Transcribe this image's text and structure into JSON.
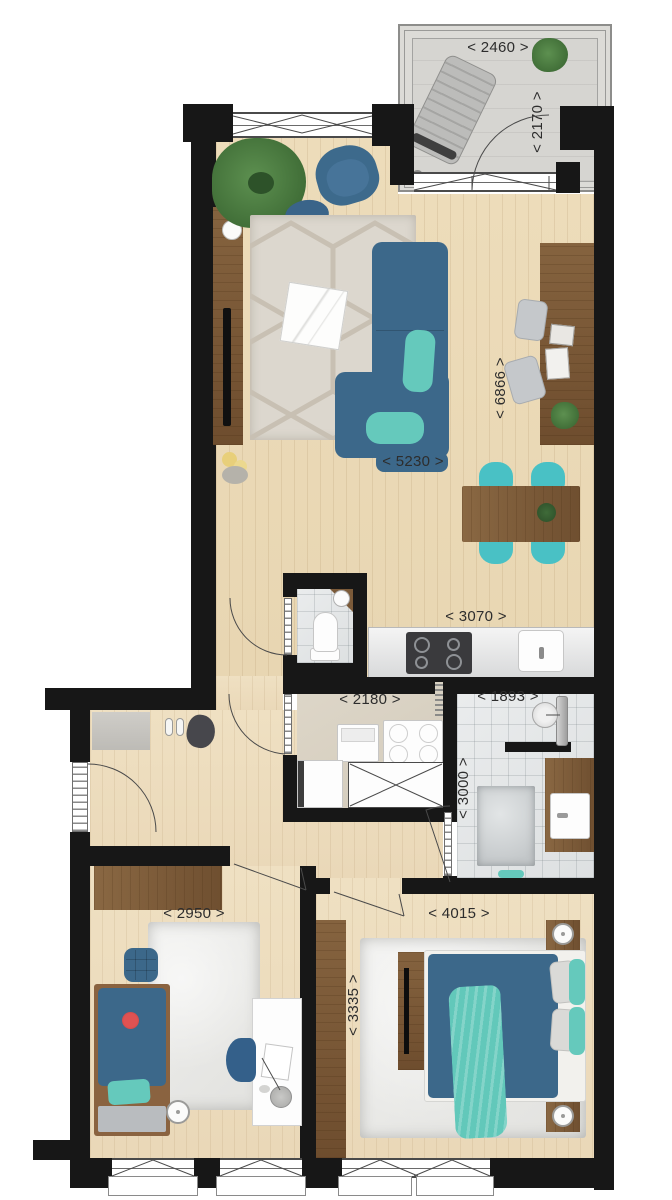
{
  "plan": {
    "type": "apartment-floor-plan-top-view",
    "dimensions": {
      "balcony_width": "< 2460 >",
      "balcony_depth": "< 2170 >",
      "living_length": "< 6866 >",
      "living_width": "< 5230 >",
      "kitchen_width": "< 3070 >",
      "storage_width": "< 2180 >",
      "bathroom_width": "< 1893 >",
      "bathroom_length": "< 3000 >",
      "bedroom_child_width": "< 2950 >",
      "bedroom_master_width": "< 4015 >",
      "bedroom_master_length": "< 3335 >"
    },
    "colors": {
      "wall": "#171717",
      "wood_floor": "#ead8b6",
      "tile_floor": "#e4e6e7",
      "balcony_floor": "#d7d6d2",
      "utility_floor": "#d8d1c2",
      "furniture_blue": "#3c688a",
      "accent_teal": "#65c9bc",
      "dining_chair_turquoise": "#49c1c5",
      "wood_furniture": "#7b5a39",
      "dimension_text": "#2d2d2d"
    },
    "rooms": {
      "balcony": {
        "furniture": [
          "sun-lounger",
          "plant"
        ]
      },
      "living_room": {
        "furniture": [
          "corner-sofa",
          "armchair",
          "pouf",
          "hexagon-rug",
          "coffee-table",
          "sideboard",
          "tv",
          "plant",
          "flowers",
          "wall-desk",
          "stools",
          "magazines",
          "dining-table",
          "dining-chairs"
        ]
      },
      "kitchen": {
        "furniture": [
          "counter",
          "cooktop",
          "sink"
        ]
      },
      "wc": {
        "furniture": [
          "toilet",
          "corner-sink"
        ]
      },
      "storage_room": {
        "furniture": [
          "washer",
          "dryer",
          "appliance",
          "technical-unit"
        ]
      },
      "bathroom": {
        "furniture": [
          "shower",
          "glass-partition",
          "vanity-sink",
          "bath-mat",
          "towel"
        ]
      },
      "hallway": {
        "furniture": [
          "doormat",
          "shoes",
          "bag",
          "entrance-door"
        ]
      },
      "bedroom_child": {
        "furniture": [
          "wardrobe",
          "single-bed",
          "pouf",
          "fluffy-rug",
          "desk",
          "desk-chair",
          "desk-lamp",
          "round-lamp"
        ]
      },
      "bedroom_master": {
        "furniture": [
          "wardrobe",
          "double-bed",
          "tv-bench",
          "nightstands",
          "lamps",
          "pillows",
          "teal-throw",
          "fluffy-rug"
        ]
      }
    }
  }
}
